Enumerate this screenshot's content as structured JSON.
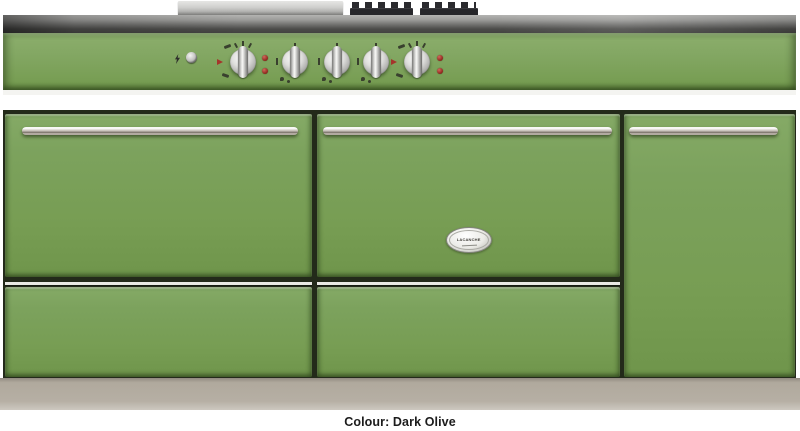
{
  "page": {
    "background_color": "#ffffff"
  },
  "product_image": {
    "type": "range-cooker-front-view",
    "badge": {
      "brand": "LACANCHE"
    },
    "colors": {
      "body_green": "#7aa05c",
      "panel_green": "#83a763",
      "stainless_light": "#c4c4c2",
      "stainless_dark": "#454543",
      "plinth_grey": "#b3aca1",
      "gap_dark": "#232a1a",
      "indicator_red": "#93281f",
      "handle_chrome": "#ccc6bf"
    },
    "controls": {
      "spark_icon": "spark-icon",
      "ignition_button": "ignition-button",
      "knobs": [
        {
          "name": "oven-thermostat-knob-left",
          "kind": "thermostat"
        },
        {
          "name": "burner-control-knob-1",
          "kind": "burner"
        },
        {
          "name": "burner-control-knob-2",
          "kind": "burner"
        },
        {
          "name": "burner-control-knob-3",
          "kind": "burner"
        },
        {
          "name": "oven-thermostat-knob-right",
          "kind": "thermostat"
        }
      ],
      "indicator_lights_count": 4
    }
  },
  "caption": {
    "text": "Colour: Dark Olive"
  }
}
